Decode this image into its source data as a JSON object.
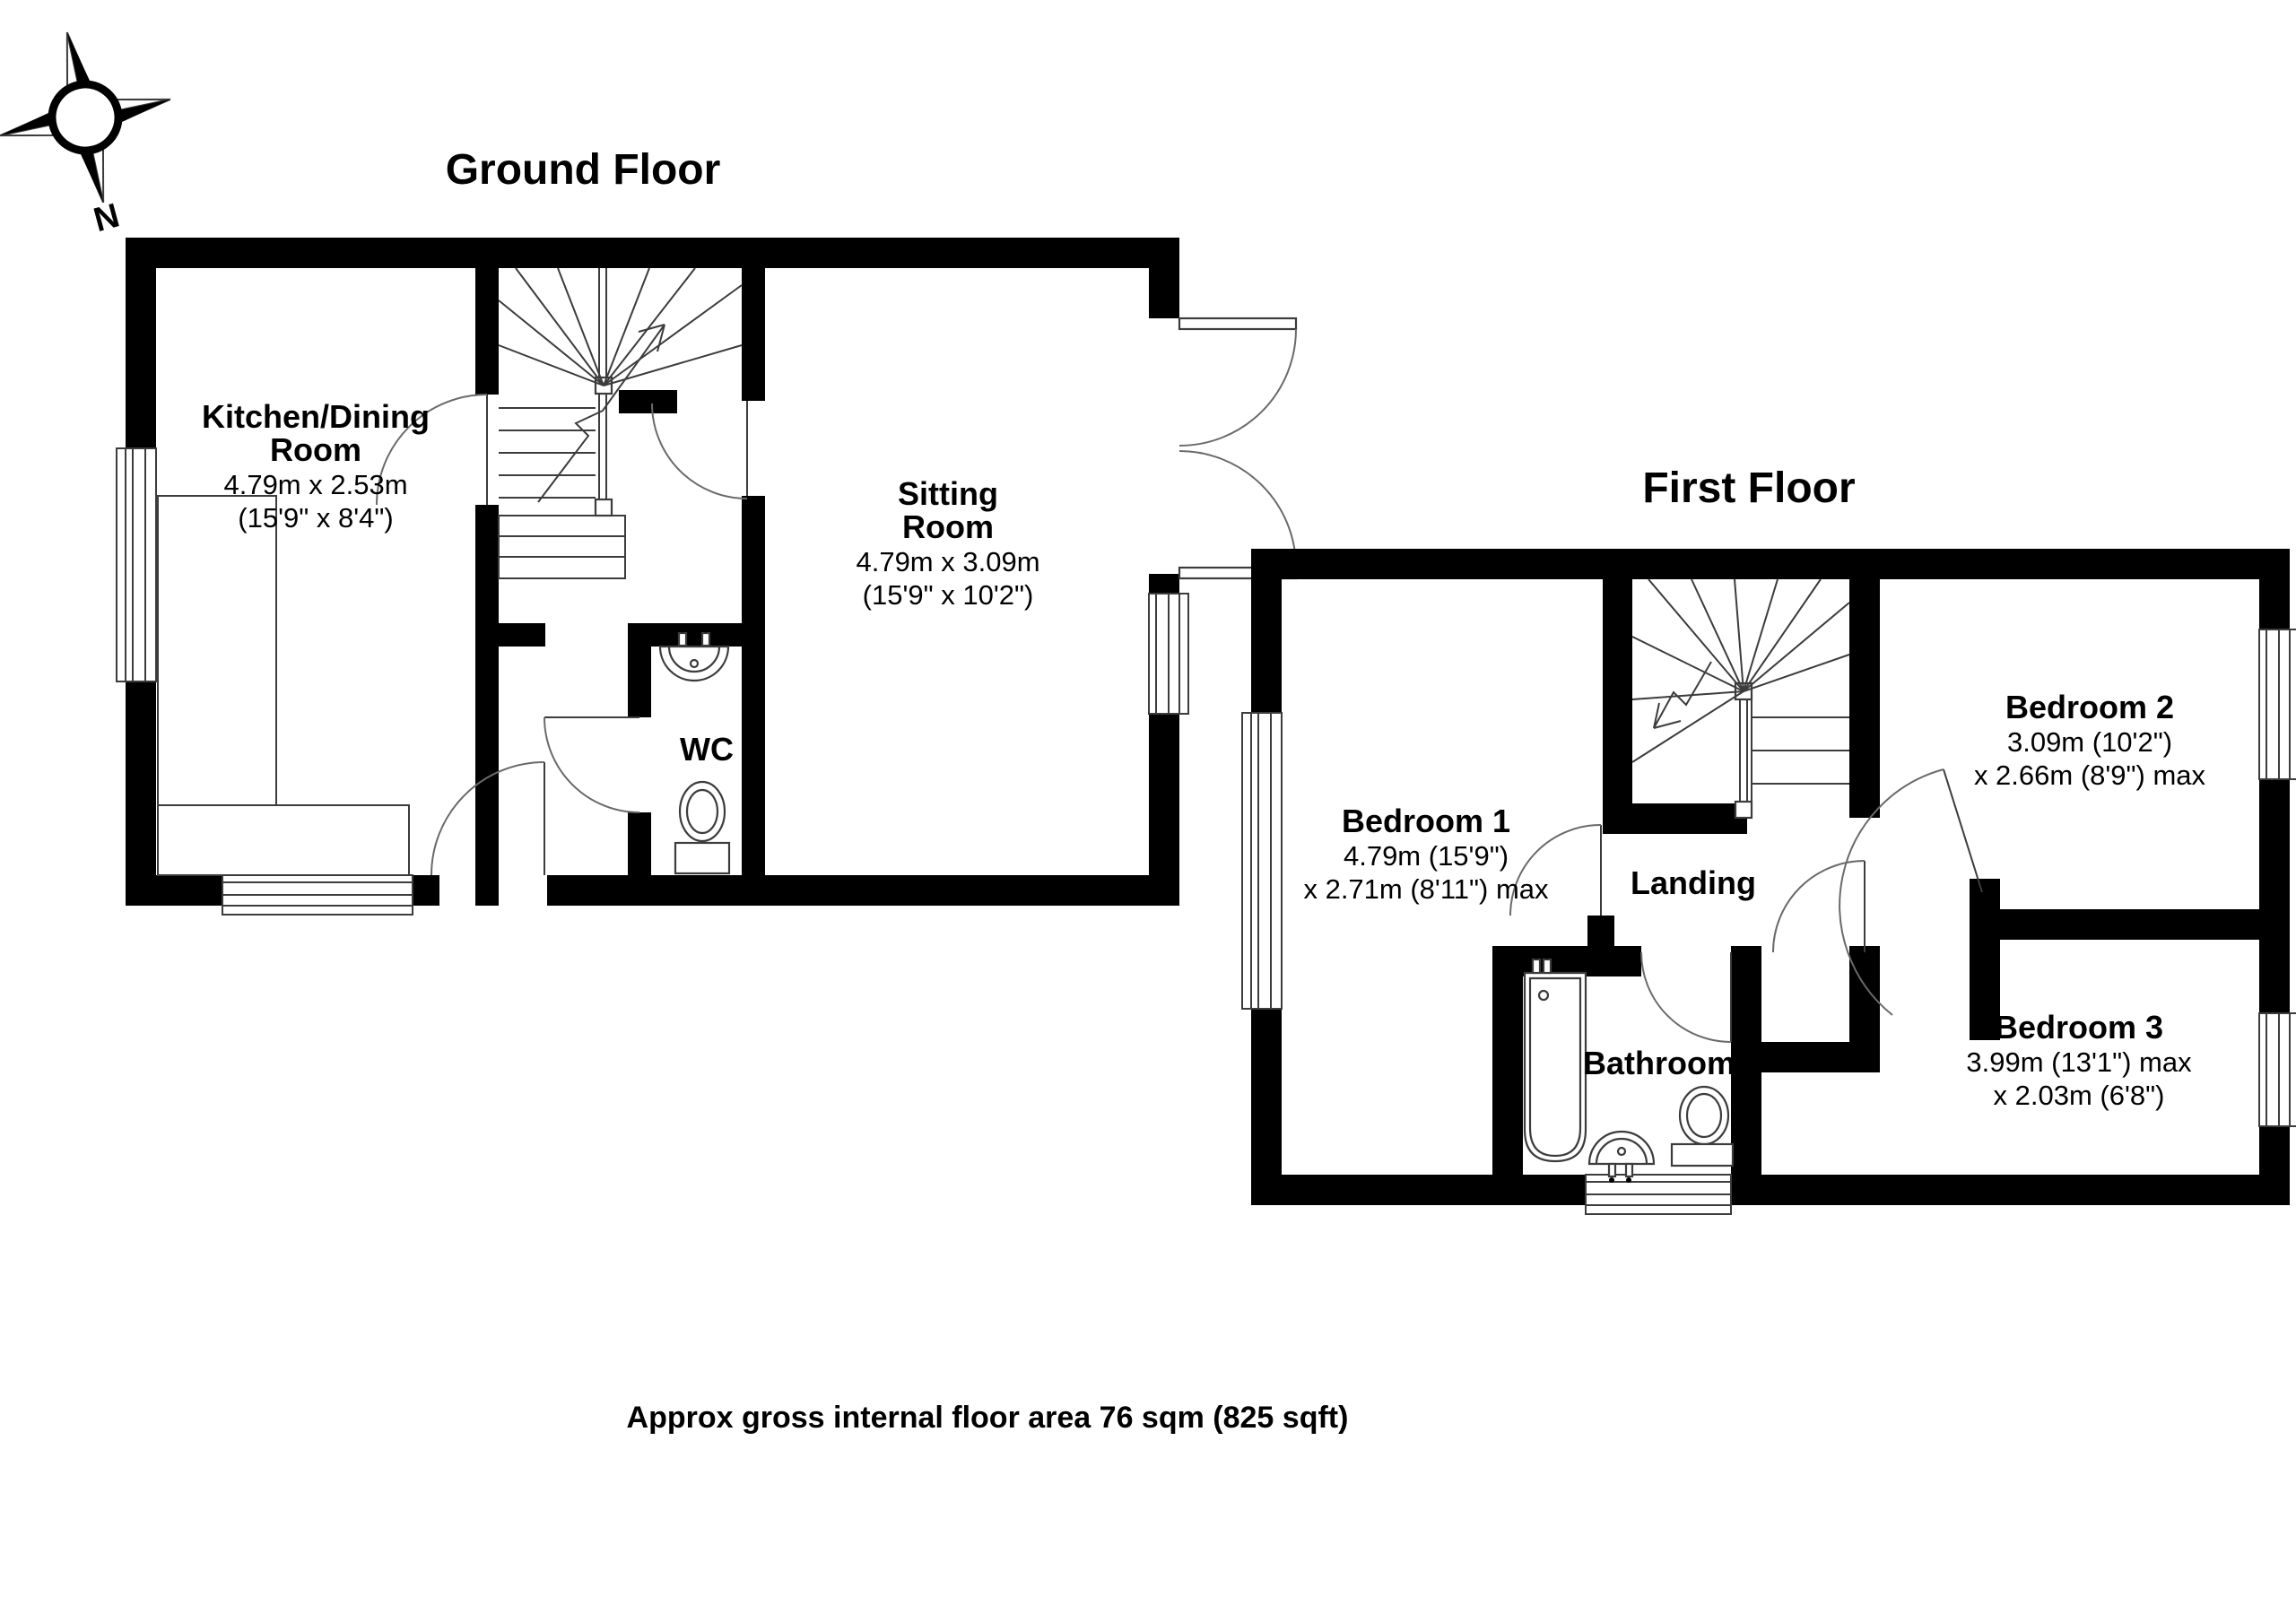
{
  "page": {
    "background": "#ffffff",
    "wall_color": "#000000",
    "line_color": "#3c3c3c"
  },
  "compass": {
    "label": "N"
  },
  "ground_floor": {
    "title": "Ground Floor",
    "rooms": {
      "kitchen": {
        "name_line1": "Kitchen/Dining",
        "name_line2": "Room",
        "dim_metric": "4.79m x 2.53m",
        "dim_imperial": "(15'9\" x 8'4\")"
      },
      "sitting": {
        "name_line1": "Sitting",
        "name_line2": "Room",
        "dim_metric": "4.79m x 3.09m",
        "dim_imperial": "(15'9\" x 10'2\")"
      },
      "wc": {
        "name": "WC"
      }
    }
  },
  "first_floor": {
    "title": "First Floor",
    "rooms": {
      "bedroom1": {
        "name": "Bedroom 1",
        "dim_line1": "4.79m (15'9\")",
        "dim_line2": "x 2.71m (8'11\") max"
      },
      "bedroom2": {
        "name": "Bedroom 2",
        "dim_line1": "3.09m (10'2\")",
        "dim_line2": "x 2.66m (8'9\") max"
      },
      "bedroom3": {
        "name": "Bedroom 3",
        "dim_line1": "3.99m (13'1\") max",
        "dim_line2": "x 2.03m (6'8\")"
      },
      "landing": {
        "name": "Landing"
      },
      "bathroom": {
        "name": "Bathroom"
      }
    }
  },
  "footer": {
    "area_note": "Approx gross internal floor area 76 sqm (825 sqft)"
  }
}
